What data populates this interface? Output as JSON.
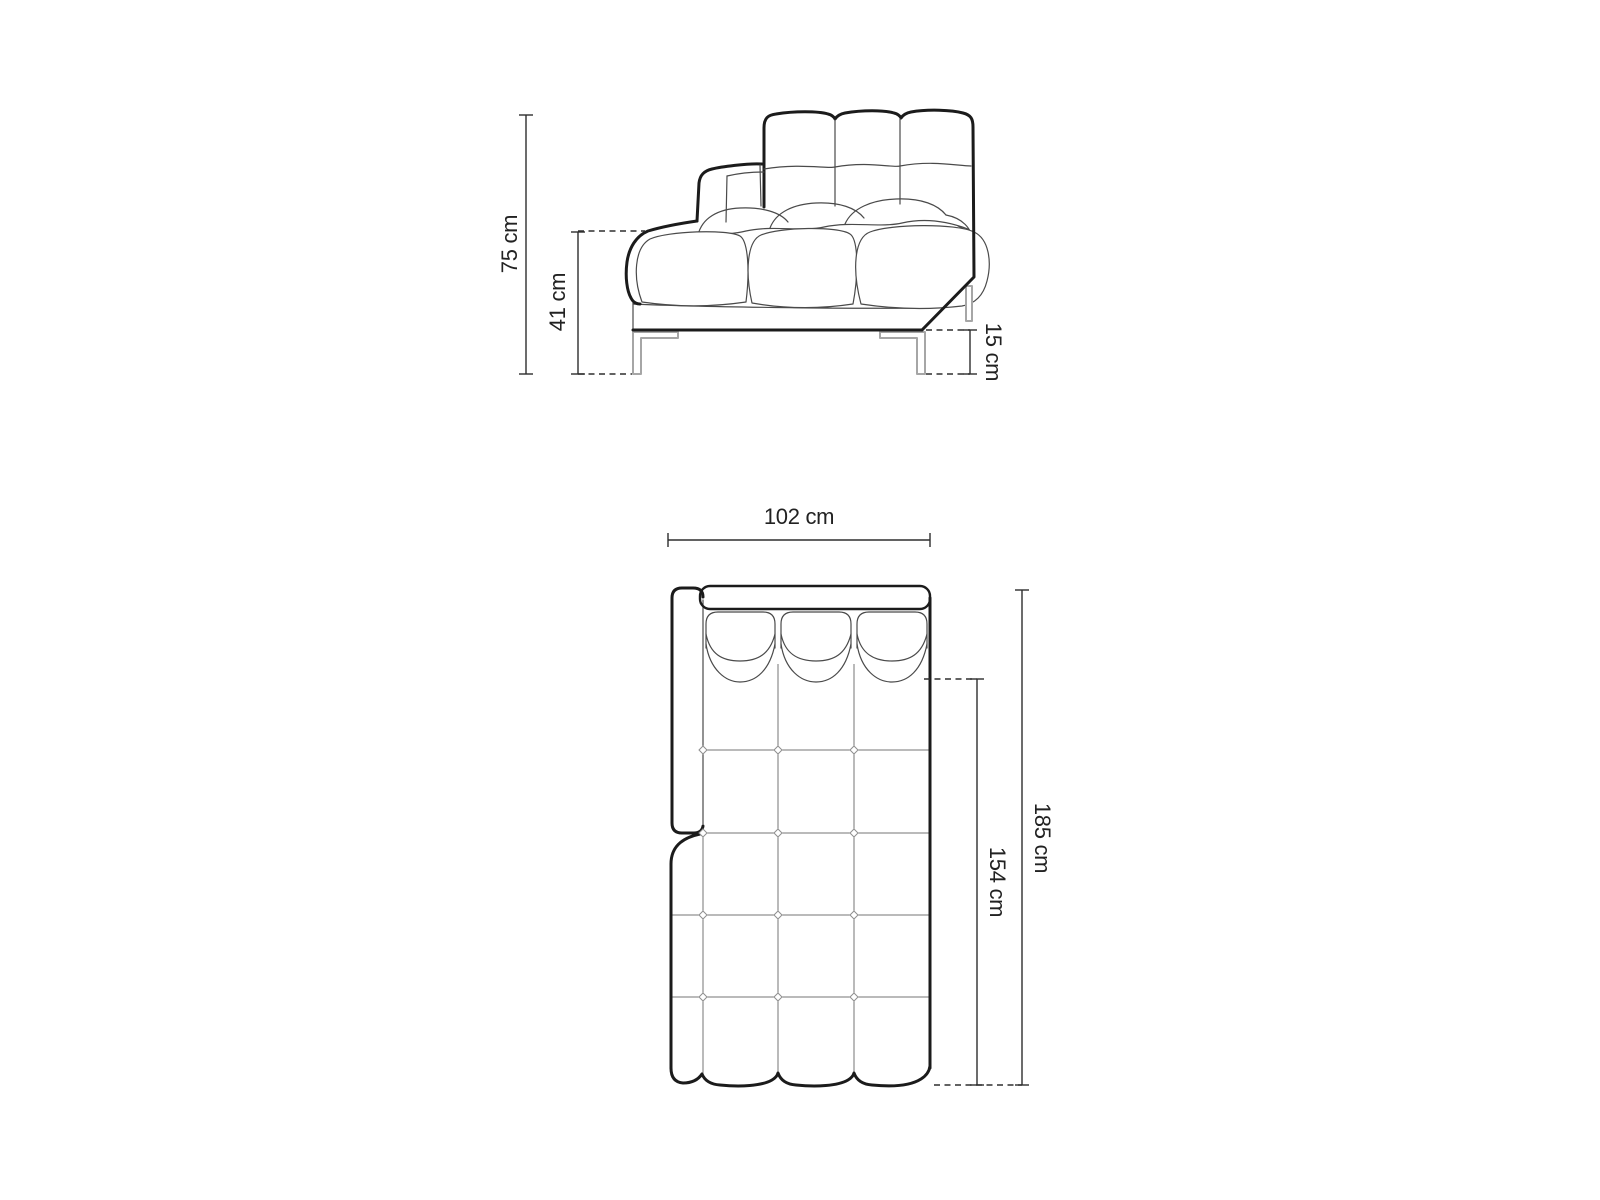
{
  "colors": {
    "bg": "#ffffff",
    "line_thick": "#1b1b1b",
    "line_thin": "#4a4a4a",
    "line_grid": "#767676",
    "line_dim": "#2e2e2e",
    "line_leg": "#a6a6a6",
    "text": "#222222"
  },
  "side_view": {
    "view": "side-elevation",
    "dimensions": {
      "total_height": {
        "value": 75,
        "unit": "cm",
        "label": "75 cm"
      },
      "seat_height": {
        "value": 41,
        "unit": "cm",
        "label": "41 cm"
      },
      "leg_height": {
        "value": 15,
        "unit": "cm",
        "label": "15 cm"
      }
    }
  },
  "plan_view": {
    "view": "top-plan",
    "dimensions": {
      "width": {
        "value": 102,
        "unit": "cm",
        "label": "102 cm"
      },
      "seat_depth": {
        "value": 154,
        "unit": "cm",
        "label": "154 cm"
      },
      "total_depth": {
        "value": 185,
        "unit": "cm",
        "label": "185 cm"
      }
    }
  }
}
